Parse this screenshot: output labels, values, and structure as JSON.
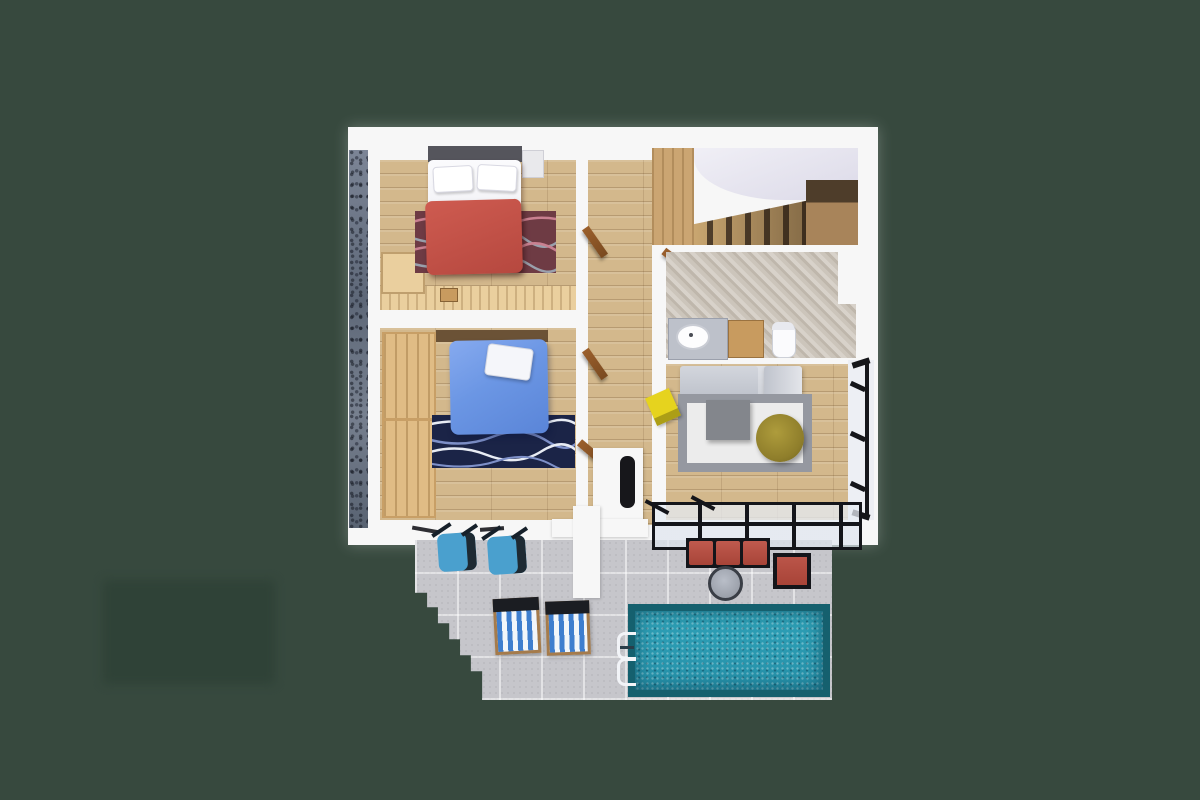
{
  "scene": {
    "type": "3d-floor-plan-render",
    "description": "Top-down 3D dollhouse render of an apartment floor with terrace and pool on a plain dark green backdrop",
    "visible_text": [],
    "rooms": [
      {
        "id": "bedroom-red",
        "contents": [
          "double-bed-red-blanket",
          "maroon-wave-rug",
          "headboard",
          "corner-desk",
          "stool",
          "wood-floor"
        ]
      },
      {
        "id": "bedroom-blue",
        "contents": [
          "double-bed-blue-duvet",
          "navy-wave-rug",
          "wardrobe",
          "wood-floor"
        ]
      },
      {
        "id": "hallway",
        "contents": [
          "wood-floor",
          "open-doors"
        ]
      },
      {
        "id": "staircase",
        "contents": [
          "wooden-steps",
          "curved-landing-ceiling"
        ]
      },
      {
        "id": "bathroom",
        "contents": [
          "herringbone-marble-floor",
          "vanity-with-sink",
          "wood-cabinet",
          "toilet",
          "door"
        ]
      },
      {
        "id": "living-room",
        "contents": [
          "gray-corner-sofa",
          "bordered-rug",
          "square-coffee-table",
          "olive-pouf",
          "yellow-magazine-rack",
          "black-framed-window-wall",
          "fireplace"
        ]
      },
      {
        "id": "terrace",
        "contents": [
          "glass-pergola",
          "red-outdoor-sofa",
          "round-side-table",
          "red-armchair",
          "blue-patio-chairs",
          "striped-deck-loungers",
          "tiled-patio",
          "corner-steps"
        ]
      },
      {
        "id": "pool",
        "contents": [
          "teal-mosaic-water",
          "ladder"
        ]
      }
    ],
    "exterior": [
      "stone-clad-left-wall",
      "white-structural-walls",
      "green-ground",
      "soft-shadow-patch-bottom-left"
    ]
  },
  "palette": {
    "bg": "#37493E",
    "shadow_patch": "#2E4136",
    "wall_white": "#F7F7F7",
    "wood_floor": "#D3B88C",
    "wood_light": "#EACF9E",
    "wardrobe": "#E0BC85",
    "stair_wood": "#C9A670",
    "stair_dark": "#52402C",
    "ceiling_light": "#DCDAE8",
    "marble_base": "#D5CFC8",
    "marble_stripe": "#BFB7AC",
    "counter_gray": "#BDC1CA",
    "cabinet_wood": "#C89B5F",
    "rug1_base": "#6E3B44",
    "blanket_red": "#CE5B50",
    "duvet_blue": "#6B96E4",
    "rug2_base": "#1B2447",
    "sofa_gray": "#BFC3CC",
    "rug_living_border": "#9598A0",
    "rug_living_center": "#ECECEC",
    "table_gray": "#83868C",
    "pouf_olive": "#8F7E2B",
    "rack_yellow": "#E6D31E",
    "window_black": "#15161A",
    "fireplace_dark": "#17171B",
    "tile_gray": "#C6C6CB",
    "beam_black": "#14151A",
    "sofa_out_red": "#A84438",
    "chair_blue": "#4AA0CE",
    "lounger_blue": "#3E7ECE",
    "frame_wood": "#A57B4B",
    "pool_deep": "#15606E",
    "pool_water": "#2FA2B8",
    "door_wood": "#9A5F2C"
  }
}
